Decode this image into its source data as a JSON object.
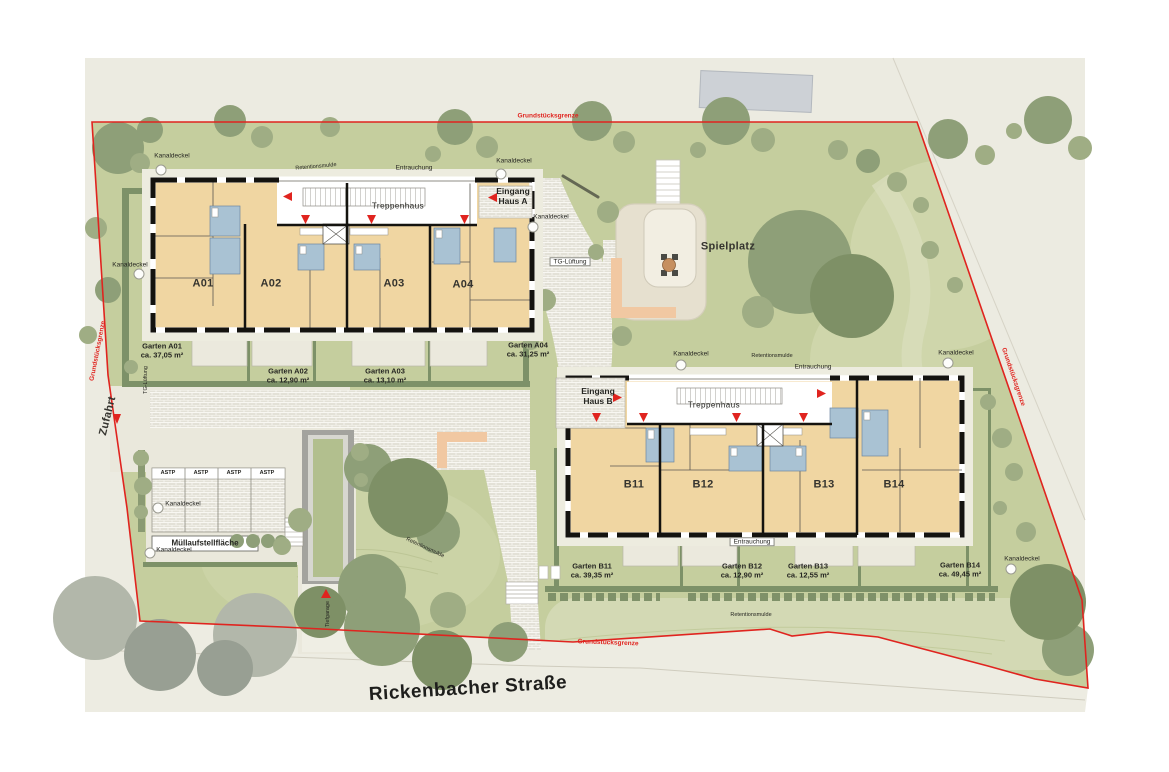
{
  "plan": {
    "street_name": "Rickenbacher Straße",
    "access_label": "Zufahrt",
    "playground_label": "Spielplatz",
    "garage_ramp_label": "Tiefgarage",
    "waste_area_label": "Müllaufstellfläche",
    "parking_stall_label": "ASTP",
    "manhole_label": "Kanaldeckel",
    "retention_swale_label": "Retentionsmulde",
    "smoke_extraction_label": "Entrauchung",
    "garage_vent_label": "TG-Lüftung",
    "stairwell_label": "Treppenhaus",
    "property_boundary_label": "Grundstücksgrenze"
  },
  "buildings": {
    "a": {
      "entrance_word": "Eingang",
      "house_name": "Haus A",
      "units": [
        "A01",
        "A02",
        "A03",
        "A04"
      ]
    },
    "b": {
      "entrance_word": "Eingang",
      "house_name": "Haus B",
      "units": [
        "B11",
        "B12",
        "B13",
        "B14"
      ]
    }
  },
  "gardens": [
    {
      "name": "Garten A01",
      "area": "ca. 37,05 m²"
    },
    {
      "name": "Garten A02",
      "area": "ca. 12,90 m²"
    },
    {
      "name": "Garten A03",
      "area": "ca. 13,10 m²"
    },
    {
      "name": "Garten A04",
      "area": "ca. 31,25 m²"
    },
    {
      "name": "Garten B11",
      "area": "ca. 39,35 m²"
    },
    {
      "name": "Garten B12",
      "area": "ca. 12,90 m²"
    },
    {
      "name": "Garten B13",
      "area": "ca. 12,55 m²"
    },
    {
      "name": "Garten B14",
      "area": "ca. 49,45 m²"
    }
  ],
  "colors": {
    "boundary_red": "#e0241f",
    "apartment_floor": "#f0d6a2",
    "bathroom_blue": "#a9c2d3",
    "lawn": "#c5ce9e",
    "hedge": "#7d9168",
    "tree_olive": "#8e9f78",
    "paving": "#e3e1d7",
    "sand": "#e6e0cf",
    "accent_path_orange": "#f1c8a2"
  }
}
